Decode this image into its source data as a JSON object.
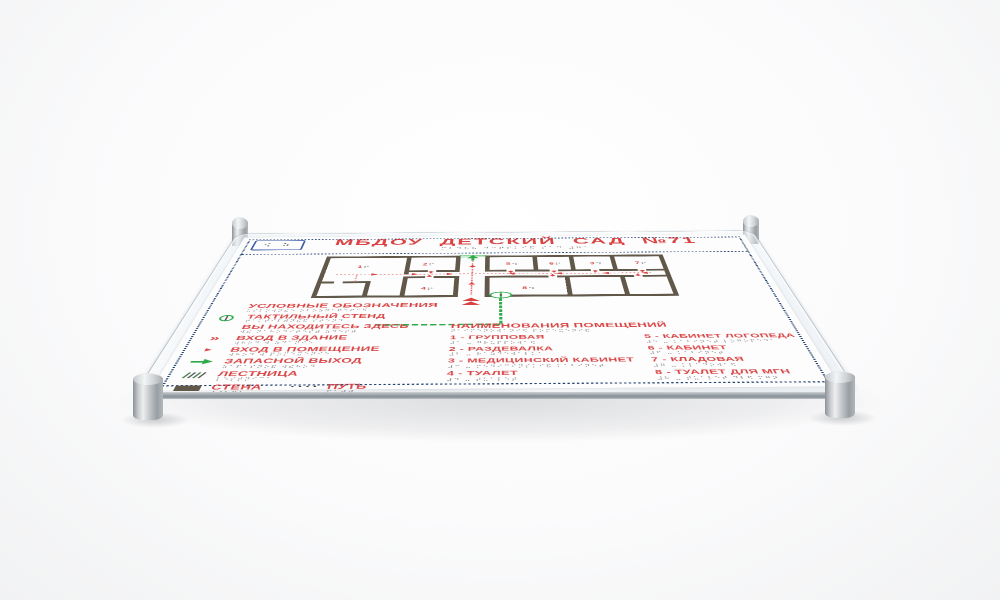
{
  "scene": {
    "background": "#f3f4f5",
    "plate_color": "#fdfdfe",
    "accent_red": "#d94343",
    "navy": "#24426f",
    "green": "#2faa4a",
    "wall_brown": "#61584a"
  },
  "sign": {
    "logo_braille": "⠪ ⠵",
    "title": "МБДОУ  ДЕТСКИЙ САД №71",
    "title_braille": "⠍⠃⠙⠕⠥ ⠙⠑⠞⠎⠅⠊⠯ ⠎⠁⠙ ⠼⠛⠁",
    "plan": {
      "markers": [
        {
          "num": "1"
        },
        {
          "num": "2"
        },
        {
          "num": "5"
        },
        {
          "num": "6"
        },
        {
          "num": "3"
        },
        {
          "num": "7"
        },
        {
          "num": "4"
        },
        {
          "num": "8"
        }
      ]
    },
    "legend": {
      "header": "УСЛОВНЫЕ ОБОЗНАЧЕНИЯ",
      "header_braille": "⠥⠎⠇⠕⠺⠝⠮⠑ ⠕⠃⠕⠵⠝⠁⠟⠑⠝⠊⠫",
      "items": [
        {
          "icon": "tactile-stand-icon",
          "label": "ТАКТИЛЬНЫЙ СТЕНД",
          "braille": "⠞⠁⠅⠞⠊⠇⠾⠝⠮⠯ ⠎⠞⠑⠝⠙"
        },
        {
          "icon": "you-are-here-line",
          "label": "ВЫ НАХОДИТЕСЬ ЗДЕСЬ",
          "braille": "⠺⠮ ⠝⠁⠓⠕⠙⠊⠞⠑⠎⠾ ⠵⠙⠑⠎⠾"
        },
        {
          "icon": "building-entrance-icon",
          "label": "ВХОД В ЗДАНИЕ",
          "braille": "⠺⠓⠕⠙ ⠺ ⠵⠙⠁⠝⠊⠑"
        },
        {
          "icon": "room-entrance-icon",
          "label": "ВХОД В ПОМЕЩЕНИЕ",
          "braille": "⠺⠓⠕⠙ ⠺ ⠏⠕⠍⠑⠭⠑⠝⠊⠑"
        },
        {
          "icon": "emergency-exit-icon",
          "label": "ЗАПАСНОЙ ВЫХОД",
          "braille": "⠵⠁⠏⠁⠎⠝⠕⠯ ⠺⠮⠓⠕⠙"
        },
        {
          "icon": "stairs-icon",
          "label": "ЛЕСТНИЦА",
          "braille": "⠇⠑⠎⠞⠝⠊⠉⠁"
        },
        {
          "icon": "wall-icon",
          "label": "СТЕНА",
          "braille": "⠎⠞⠑⠝⠁"
        }
      ],
      "path_item": {
        "label": "ПУТЬ",
        "braille": "⠏⠥⠞⠾"
      }
    },
    "rooms": {
      "header": "НАИМЕНОВАНИЯ ПОМЕЩЕНИЙ",
      "header_braille": "⠝⠁⠊⠍⠑⠝⠕⠺⠁⠝⠊⠫ ⠏⠕⠍⠑⠭⠑⠝⠊⠯",
      "column_left": [
        {
          "label": "1 - ГРУППОВАЯ",
          "braille": "⠼⠁ ⠤ ⠛⠗⠥⠏⠏⠕⠺⠁⠫"
        },
        {
          "label": "2 - РАЗДЕВАЛКА",
          "braille": "⠼⠃ ⠤ ⠗⠁⠵⠙⠑⠺⠁⠇⠅⠁"
        },
        {
          "label": "3 - МЕДИЦИНСКИЙ КАБИНЕТ",
          "braille": "⠼⠉ ⠤ ⠍⠑⠙⠊⠉⠊⠝⠎⠅⠊⠯ ⠅⠁⠃⠊⠝⠑⠞"
        },
        {
          "label": "4 - ТУАЛЕТ",
          "braille": "⠼⠙ ⠤ ⠞⠥⠁⠇⠑⠞"
        }
      ],
      "column_right": [
        {
          "label": "5 - КАБИНЕТ ЛОГОПЕДА",
          "braille": "⠼⠑ ⠤ ⠅⠁⠃⠊⠝⠑⠞ ⠇⠕⠛⠕⠏⠑⠙⠁"
        },
        {
          "label": "6 - КАБИНЕТ",
          "braille": "⠼⠋ ⠤ ⠅⠁⠃⠊⠝⠑⠞"
        },
        {
          "label": "7 - КЛАДОВАЯ",
          "braille": "⠼⠛ ⠤ ⠅⠇⠁⠙⠕⠺⠁⠫"
        },
        {
          "label": "8 - ТУАЛЕТ ДЛЯ МГН",
          "braille": "⠼⠓ ⠤ ⠞⠥⠁⠇⠑⠞ ⠙⠇⠫ ⠍⠛⠝"
        }
      ]
    }
  }
}
